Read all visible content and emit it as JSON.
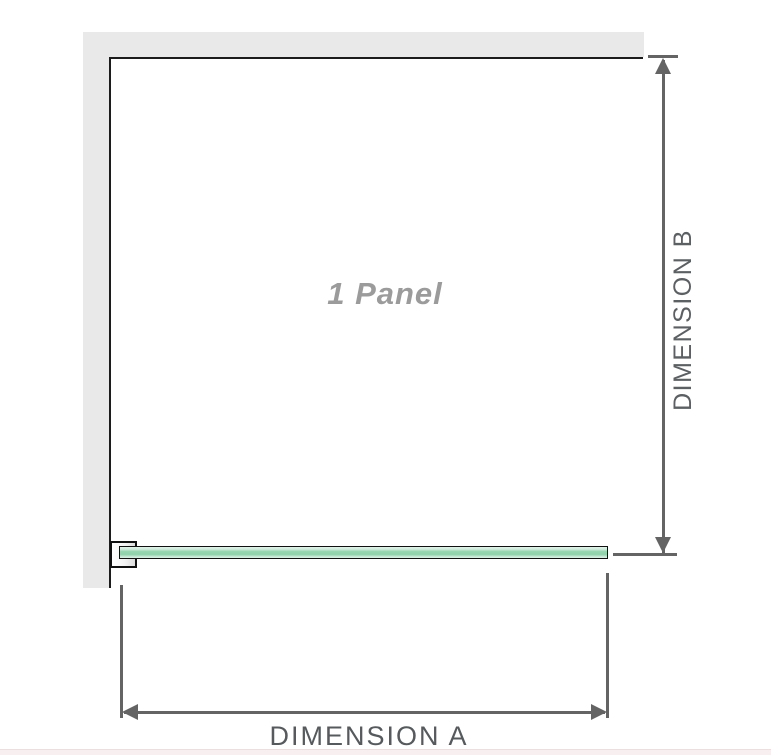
{
  "diagram": {
    "title": "shower-screen-panel-dimension-diagram",
    "panel_label": "1 Panel",
    "dimension_a": {
      "label": "DIMENSION A",
      "orientation": "horizontal",
      "measures": "panel width"
    },
    "dimension_b": {
      "label": "DIMENSION B",
      "orientation": "vertical",
      "measures": "panel height"
    }
  },
  "colors": {
    "wall_fill": "#e9e9e9",
    "wall_edge": "#1c1c1c",
    "glass_green_light": "#cdeadb",
    "glass_green_mid": "#8fd2ac",
    "glass_border": "#111111",
    "dimension_line": "#646464",
    "dimension_label": "#565a5d",
    "panel_label": "#9b9b9b",
    "footer_band": "#f7eff0"
  }
}
